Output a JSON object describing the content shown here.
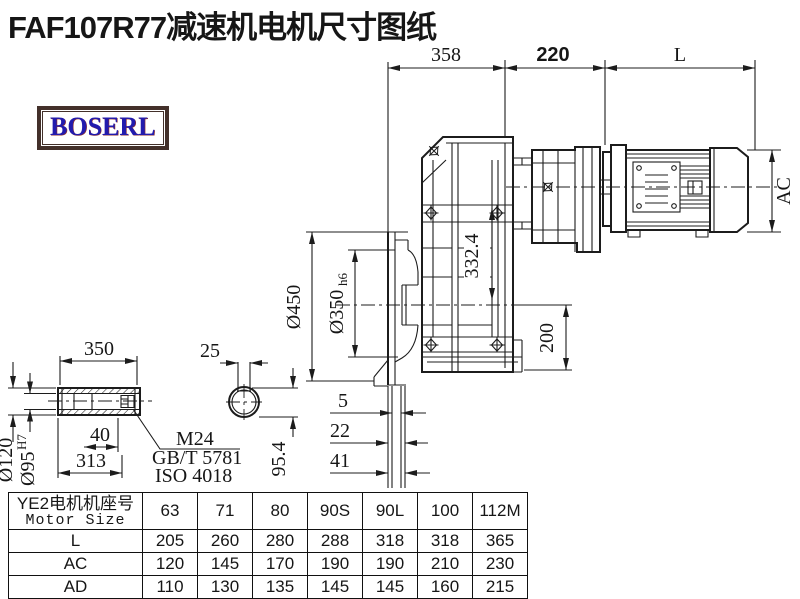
{
  "title": "FAF107R77减速机电机尺寸图纸",
  "logo": {
    "text": "BOSERL"
  },
  "drawing": {
    "top_dims": {
      "d358": "358",
      "d220": "220",
      "dL": "L"
    },
    "motor": {
      "ac": "AC"
    },
    "gearbox": {
      "d332": "332.4",
      "d450": "Ø450",
      "d350": "Ø350",
      "d350_tol": "h6",
      "d200": "200",
      "d5": "5",
      "d22": "22",
      "d41": "41"
    },
    "shaft": {
      "d350": "350",
      "d25": "25",
      "d120": "Ø120",
      "d95": "Ø95",
      "d95_tol": "H7",
      "d40": "40",
      "d313": "313",
      "d954": "95.4",
      "thread": "M24",
      "std1": "GB/T 5781",
      "std2": "ISO 4018"
    }
  },
  "table": {
    "header_cn": "YE2电机机座号",
    "header_en": "Motor Size",
    "columns": [
      "63",
      "71",
      "80",
      "90S",
      "90L",
      "100",
      "112M"
    ],
    "rows": [
      {
        "label": "L",
        "values": [
          "205",
          "260",
          "280",
          "288",
          "318",
          "318",
          "365"
        ]
      },
      {
        "label": "AC",
        "values": [
          "120",
          "145",
          "170",
          "190",
          "190",
          "210",
          "230"
        ]
      },
      {
        "label": "AD",
        "values": [
          "110",
          "130",
          "135",
          "145",
          "145",
          "160",
          "215"
        ]
      }
    ]
  }
}
